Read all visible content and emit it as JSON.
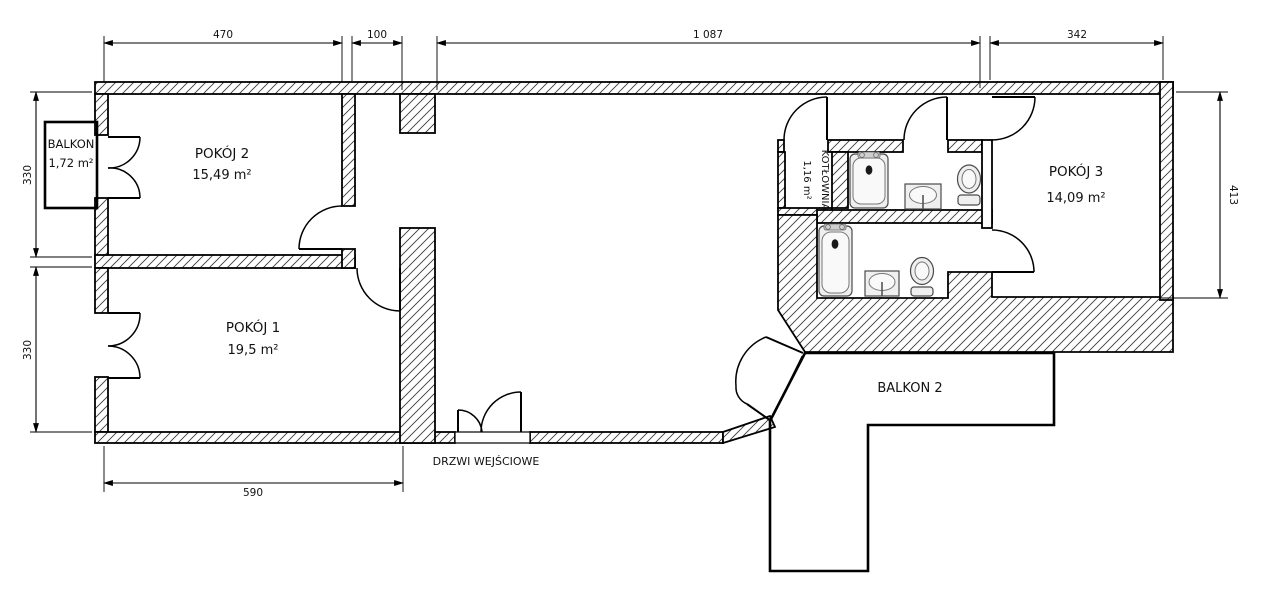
{
  "rooms": {
    "pokoj1": {
      "name": "POKÓJ 1",
      "area": "19,5 m²"
    },
    "pokoj2": {
      "name": "POKÓJ 2",
      "area": "15,49 m²"
    },
    "pokoj3": {
      "name": "POKÓJ 3",
      "area": "14,09 m²"
    },
    "kotlownia": {
      "name": "KOTŁOWNIA",
      "area": "1,16 m²"
    },
    "balkon1": {
      "name": "BALKON",
      "area": "1,72 m²"
    },
    "balkon2": {
      "name": "BALKON 2"
    }
  },
  "labels": {
    "entrance_door": "DRZWI WEJŚCIOWE"
  },
  "dimensions": {
    "top_470": "470",
    "top_100": "100",
    "top_1087": "1 087",
    "top_342": "342",
    "left_330_upper": "330",
    "left_330_lower": "330",
    "right_413": "413",
    "bottom_590": "590"
  },
  "colors": {
    "line": "#000000",
    "hatch": "#3c3c3c",
    "fixture_fill": "#efefef",
    "background": "#ffffff"
  }
}
